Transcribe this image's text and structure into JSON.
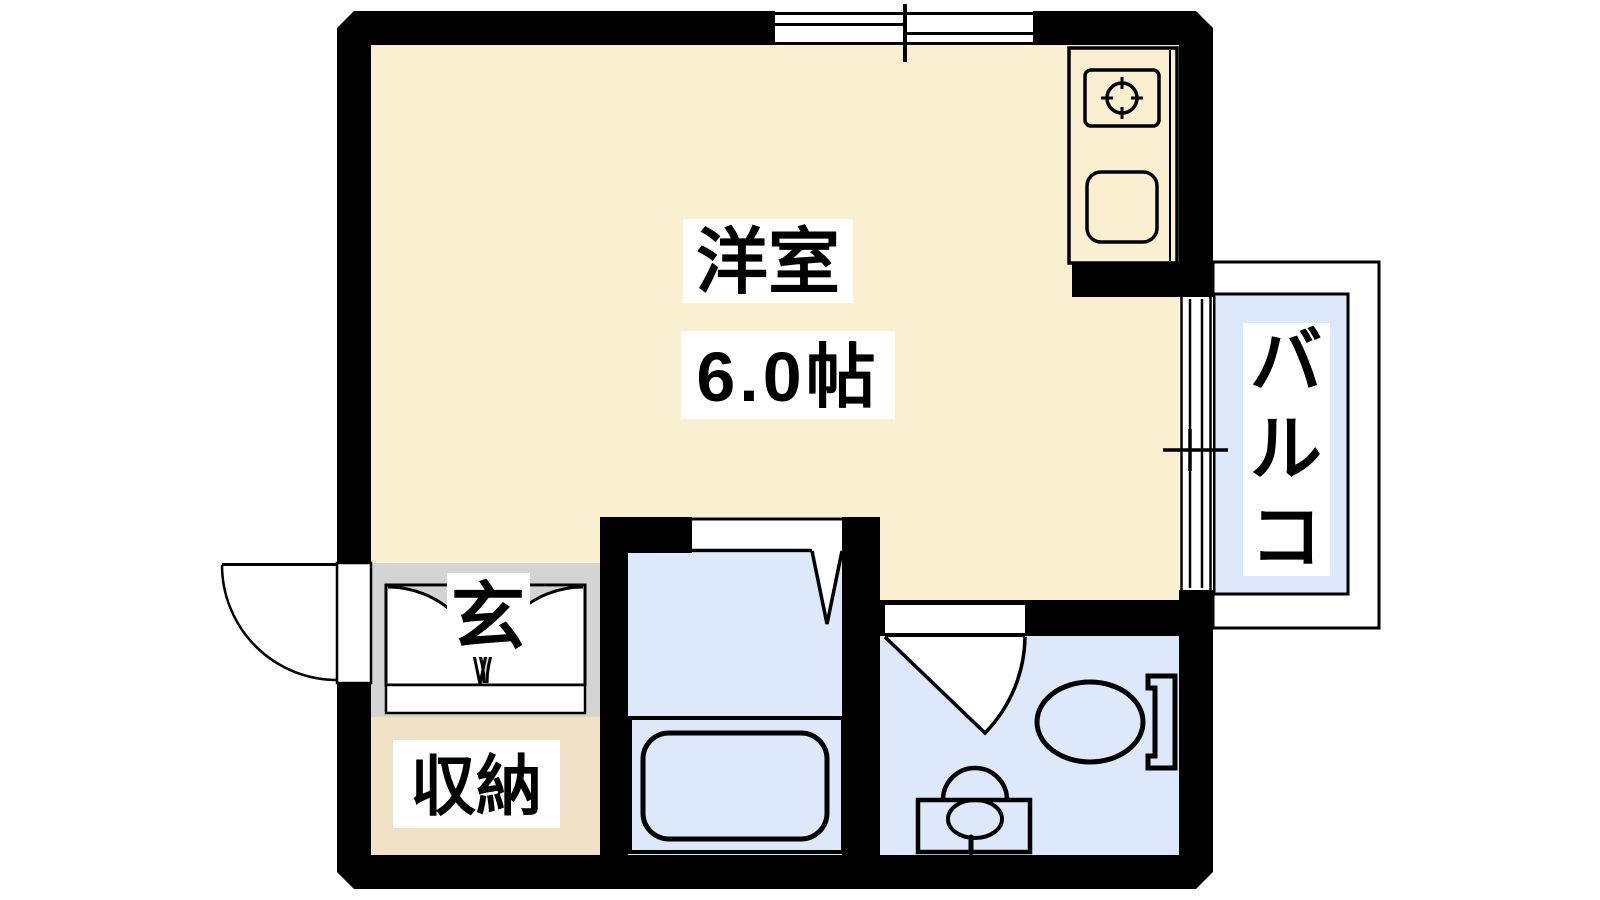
{
  "floor_plan": {
    "rooms": {
      "living": {
        "name": "洋室",
        "size": "6.0帖"
      },
      "entrance": {
        "label": "玄"
      },
      "storage": {
        "label": "収納"
      },
      "balcony": {
        "label": "バルコ"
      }
    },
    "colors": {
      "background": "#FFFFFF",
      "wall": "#000000",
      "living_floor": "#FBEFD1",
      "storage_floor": "#F1E1C6",
      "entrance_floor": "#D4D4D4",
      "water_floor": "#DDE9FB",
      "balcony_floor": "#DDE9FB",
      "label_background": "#FFFFFF"
    },
    "fixtures": [
      "entrance-swing-door",
      "genkan-double-door",
      "sliding-window",
      "balcony-sliding-door",
      "kitchen-counter",
      "gas-stove-burner",
      "kitchen-sink",
      "bathtub",
      "bathroom-swing-door",
      "toilet-swing-door",
      "toilet",
      "wash-basin"
    ]
  }
}
